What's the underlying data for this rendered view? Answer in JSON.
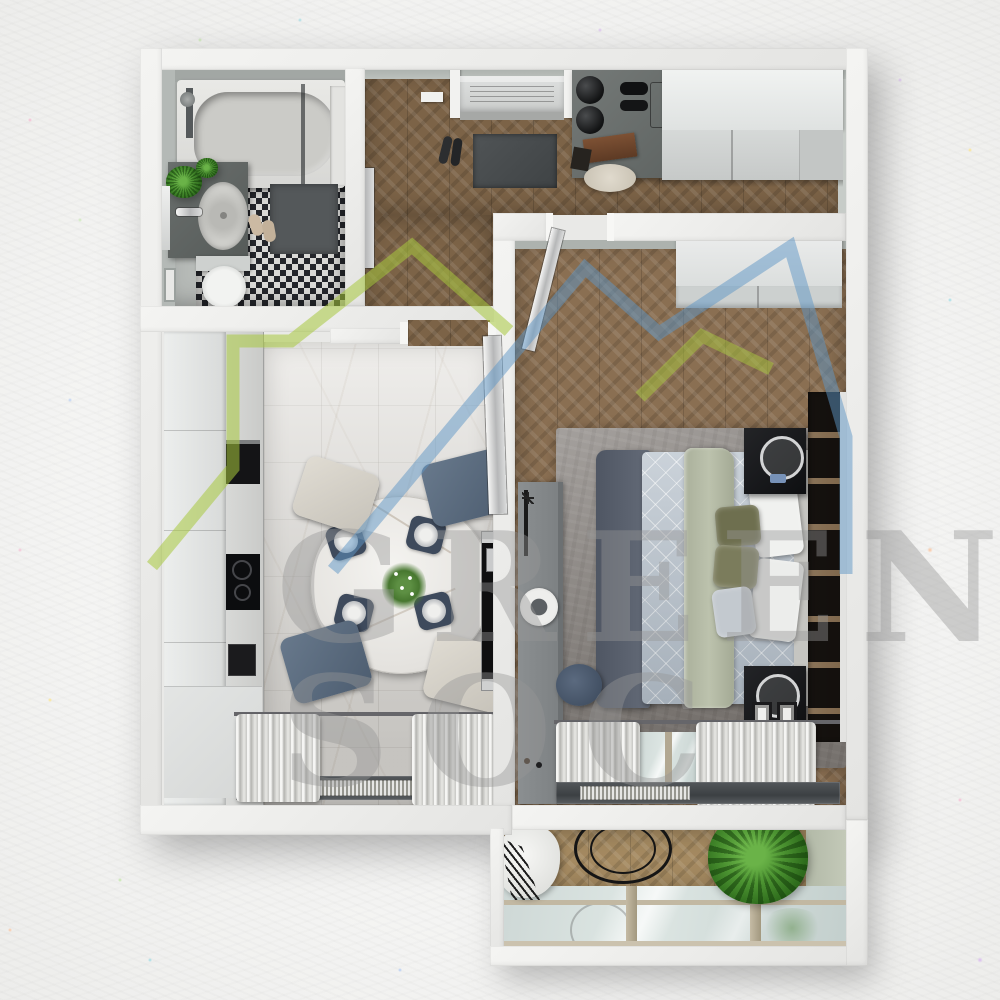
{
  "image": {
    "kind": "3d-floor-plan-render",
    "view": "top-down",
    "background": "white watercolor paper with multicolor specks"
  },
  "watermark": {
    "line1": "GREEN",
    "line2": "SOC",
    "logo": "double-house-outline",
    "logo_green": "#a7c83e",
    "logo_blue": "#5d96c5"
  },
  "palette": {
    "wall": "#eeeeee",
    "wood_hall": "#7c6347",
    "wood_bedroom": "#8a6f52",
    "wood_balcony": "#a58a61",
    "marble_floor": "#e7e5e1",
    "bath_tile": "#24262b",
    "rug": "#908b87",
    "duvet": "#b9c3cd",
    "sage_throw": "#b6bca7",
    "olive_pillow": "#71724f",
    "chair_blue": "#5c6d80",
    "chair_cream": "#d6d2c9",
    "appliance": "#141416",
    "nightstand": "#17181b"
  },
  "rooms": [
    {
      "id": "bathroom",
      "label": "Bathroom",
      "furniture": [
        "bathtub",
        "shower",
        "glass-screen",
        "vanity-with-sink",
        "fern-plants",
        "toilet",
        "bath-mat",
        "slippers",
        "diamond-tile-floor"
      ]
    },
    {
      "id": "hallway",
      "label": "Hallway",
      "furniture": [
        "entrance-door",
        "light-switch",
        "doormat",
        "shoes",
        "console-desk",
        "two-black-lamps",
        "books",
        "pouf",
        "wardrobe",
        "leaning-mirror",
        "herringbone-floor"
      ]
    },
    {
      "id": "bedroom",
      "label": "Bedroom",
      "furniture": [
        "wardrobe",
        "open-door",
        "double-bed",
        "headboard",
        "white-pillows",
        "olive-pillows",
        "sage-runner",
        "dark-throw",
        "rug",
        "nightstand-with-mirror",
        "nightstand-with-frames",
        "long-dresser",
        "record-player",
        "stool",
        "shelving-wall",
        "window-curtains",
        "radiator"
      ]
    },
    {
      "id": "kitchen-living",
      "label": "Kitchen / Living room",
      "furniture": [
        "tall-cabinets",
        "countertop",
        "oven",
        "induction-hob",
        "coffee-machine",
        "round-dining-table",
        "four-chairs",
        "place-settings",
        "flower-centerpiece",
        "tv-panel",
        "marble-floor",
        "window-curtains",
        "radiator"
      ]
    },
    {
      "id": "balcony",
      "label": "Balcony",
      "furniture": [
        "hanging-chair",
        "macrame-fringe",
        "round-frame",
        "green-plant",
        "glazing",
        "herringbone-floor"
      ]
    }
  ]
}
